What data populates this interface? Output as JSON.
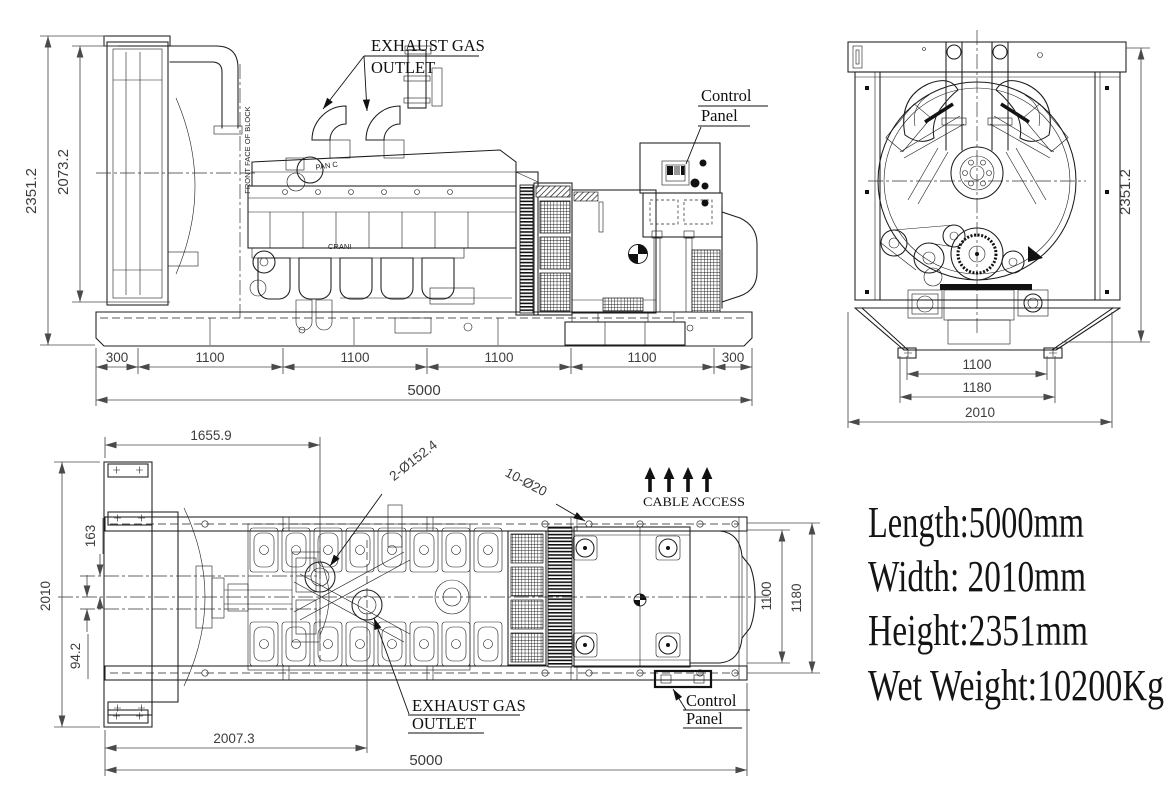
{
  "drawing": {
    "side_view": {
      "dim_height_overall": "2351.2",
      "dim_height_inner": "2073.2",
      "dim_chain": [
        "300",
        "1100",
        "1100",
        "1100",
        "1100",
        "300"
      ],
      "dim_length_overall": "5000",
      "label_exhaust_line1": "EXHAUST GAS",
      "label_exhaust_line2": "OUTLET",
      "label_control_line1": "Control",
      "label_control_line2": "Panel",
      "label_front_face": "FRONT FACE OF BLOCK",
      "marking_fan": "PAN C",
      "marking_crank": "CRANI"
    },
    "end_view": {
      "dim_height_overall": "2351.2",
      "dim_base_inner": "1100",
      "dim_base_outer": "1180",
      "dim_width_overall": "2010"
    },
    "plan_view": {
      "dim_front_face": "1655.9",
      "dim_width_overall": "2010",
      "dim_fan_offset": "163",
      "dim_crank_offset": "94.2",
      "dim_outlet_position": "2007.3",
      "dim_length_overall": "5000",
      "dim_base_inner": "1100",
      "dim_base_outer": "1180",
      "label_exhaust_holes": "2-Ø152.4",
      "label_mounting_holes": "10-Ø20",
      "label_cable_access": "CABLE ACCESS",
      "label_exhaust_line1": "EXHAUST GAS",
      "label_exhaust_line2": "OUTLET",
      "label_control_line1": "Control",
      "label_control_line2": "Panel"
    },
    "specs": {
      "length": "Length:5000mm",
      "width": "Width: 2010mm",
      "height": "Height:2351mm",
      "wet_weight": "Wet Weight:10200Kg"
    }
  }
}
